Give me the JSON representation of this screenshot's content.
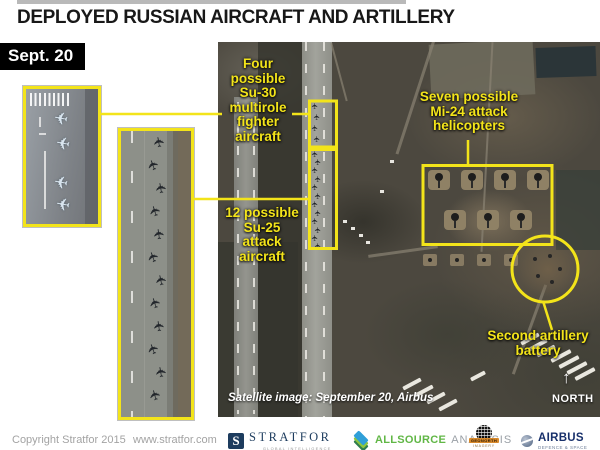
{
  "header": {
    "title": "DEPLOYED RUSSIAN AIRCRAFT AND ARTILLERY",
    "date": "Sept. 20"
  },
  "annotations": {
    "su30": {
      "label": "Four\npossible\nSu-30\nmultirole\nfighter\naircraft",
      "count": 4
    },
    "su25": {
      "label": "12 possible\nSu-25\nattack\naircraft",
      "count": 12
    },
    "mi24": {
      "label": "Seven possible\nMi-24 attack\nhelicopters",
      "count": 7
    },
    "artillery": {
      "label": "Second artillery\nbattery"
    }
  },
  "satellite": {
    "caption": "Satellite image: September 20, Airbus",
    "compass_label": "NORTH"
  },
  "footer": {
    "copyright": "Copyright Stratfor 2015",
    "url": "www.stratfor.com",
    "logos": {
      "stratfor": {
        "monogram": "S",
        "name": "STRATFOR",
        "tagline": "GLOBAL INTELLIGENCE"
      },
      "allsource": {
        "name": "ALLSOURCE",
        "suffix": "ANALYSIS"
      },
      "geonorth": {
        "name": "GEONORTH",
        "tagline": "IMAGERY"
      },
      "airbus": {
        "name": "AIRBUS",
        "tagline": "DEFENCE & SPACE"
      }
    }
  },
  "icons": {
    "aircraft": "✈",
    "north_arrow": "↑"
  },
  "colors": {
    "annotation_yellow": "#f3e41a",
    "title_black": "#181818",
    "date_box": "#000000"
  }
}
